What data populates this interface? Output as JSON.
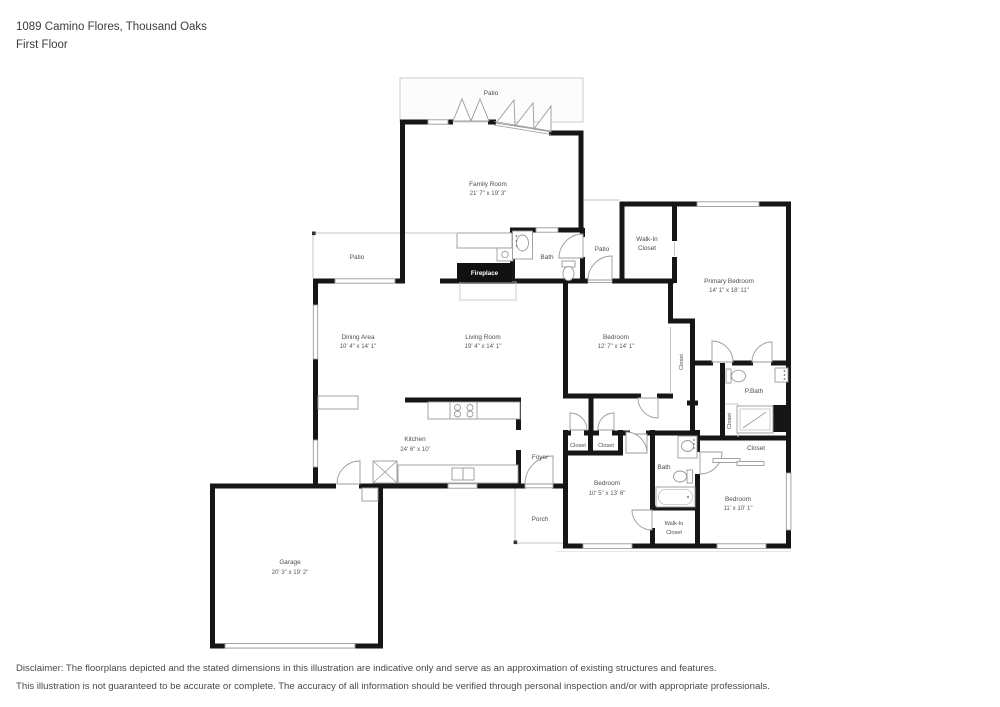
{
  "header": {
    "address": "1089 Camino Flores, Thousand Oaks",
    "floor": "First Floor"
  },
  "colors": {
    "wall": "#161616",
    "thin_line": "#c4c4c4",
    "fireplace_bg": "#111111",
    "label_text": "#4d4d4d"
  },
  "floorplan": {
    "rooms": {
      "patio_top": {
        "label": "Patio"
      },
      "family_room": {
        "label": "Family Room",
        "dims": "21' 7\" x 19' 3\""
      },
      "patio_left": {
        "label": "Patio"
      },
      "bath_top": {
        "label": "Bath"
      },
      "patio_mid": {
        "label": "Patio"
      },
      "wic_top": {
        "line1": "Walk-In",
        "line2": "Closet"
      },
      "primary_bedroom": {
        "label": "Primary Bedroom",
        "dims": "14' 1\" x 18' 11\""
      },
      "dining_area": {
        "label": "Dining Area",
        "dims": "10' 4\" x 14' 1\""
      },
      "living_room": {
        "label": "Living Room",
        "dims": "19' 4\" x 14' 1\""
      },
      "bedroom_mid": {
        "label": "Bedroom",
        "dims": "12' 7\" x 14' 1\""
      },
      "fireplace": {
        "label": "Fireplace"
      },
      "closet_1": {
        "label": "Closet"
      },
      "p_bath": {
        "label": "P.Bath"
      },
      "closet_2": {
        "label": "Closet"
      },
      "closet_br": {
        "label": "Closet"
      },
      "kitchen": {
        "label": "Kitchen",
        "dims": "24' 6\" x 10'"
      },
      "foyer": {
        "label": "Foyer"
      },
      "closet_a": {
        "label": "Closet"
      },
      "closet_b": {
        "label": "Closet"
      },
      "bath_bottom": {
        "label": "Bath"
      },
      "bedroom_bl": {
        "label": "Bedroom",
        "dims": "10' 5\" x 13' 6\""
      },
      "wic_bottom": {
        "line1": "Walk-In",
        "line2": "Closet"
      },
      "bedroom_br": {
        "label": "Bedroom",
        "dims": "11' x 10' 1\""
      },
      "porch": {
        "label": "Porch"
      },
      "garage": {
        "label": "Garage",
        "dims": "20' 3\" x 19' 2\""
      }
    }
  },
  "disclaimer": {
    "line1": "Disclaimer: The floorplans depicted and the stated dimensions in this illustration are indicative only and serve as an approximation of existing structures and features.",
    "line2": "This illustration is not guaranteed to be accurate or complete. The accuracy of all information should be verified through personal inspection and/or with appropriate professionals."
  }
}
